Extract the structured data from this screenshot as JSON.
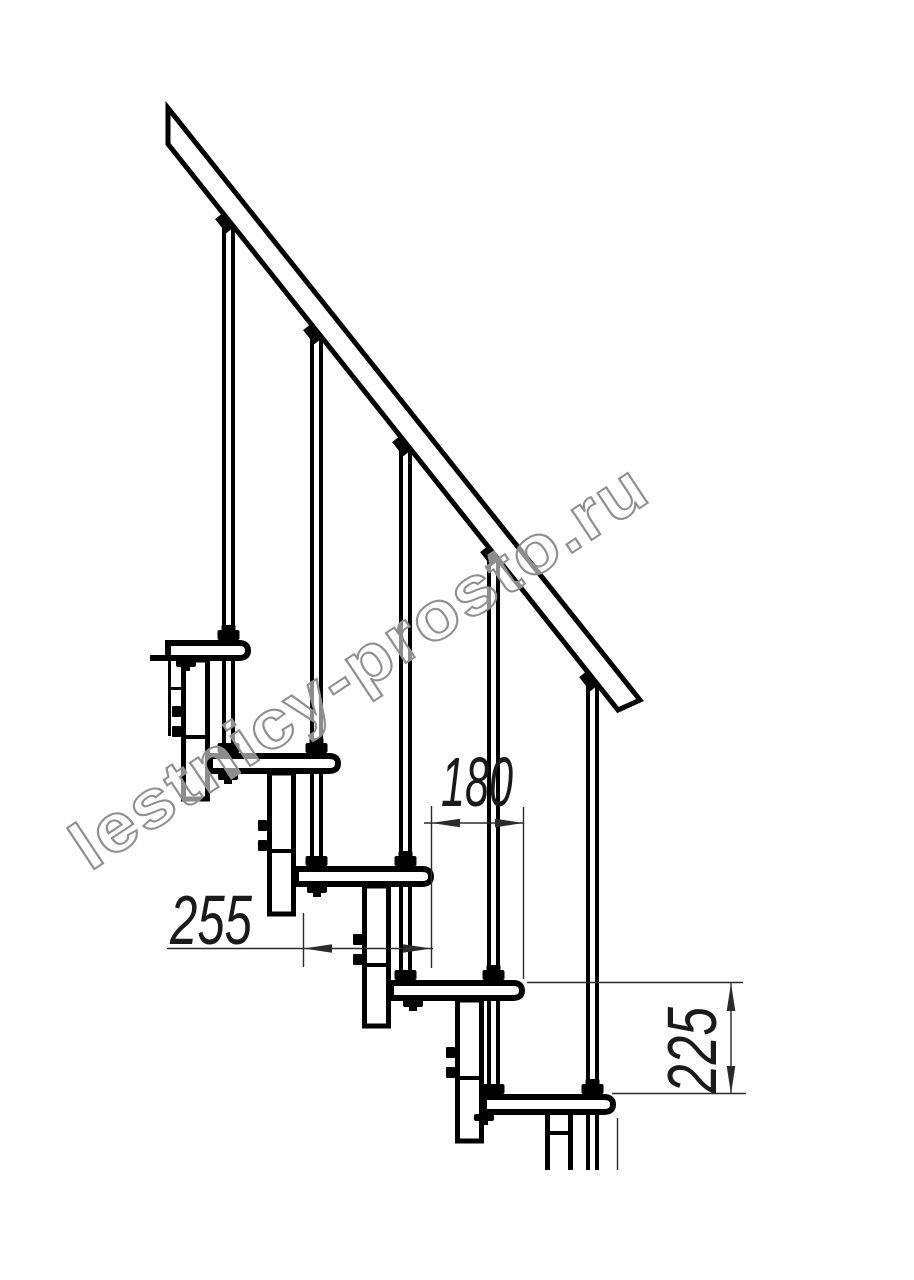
{
  "colors": {
    "background": "#ffffff",
    "drawing_line": "#000000",
    "dimension_line": "#2b2b2b",
    "watermark": "#8f8f8f"
  },
  "watermark": {
    "text": "lestnicy-prosto.ru"
  },
  "dimensions": {
    "run": {
      "value": "255",
      "orientation": "horizontal"
    },
    "offset": {
      "value": "180",
      "orientation": "horizontal"
    },
    "rise": {
      "value": "225",
      "orientation": "vertical"
    }
  }
}
